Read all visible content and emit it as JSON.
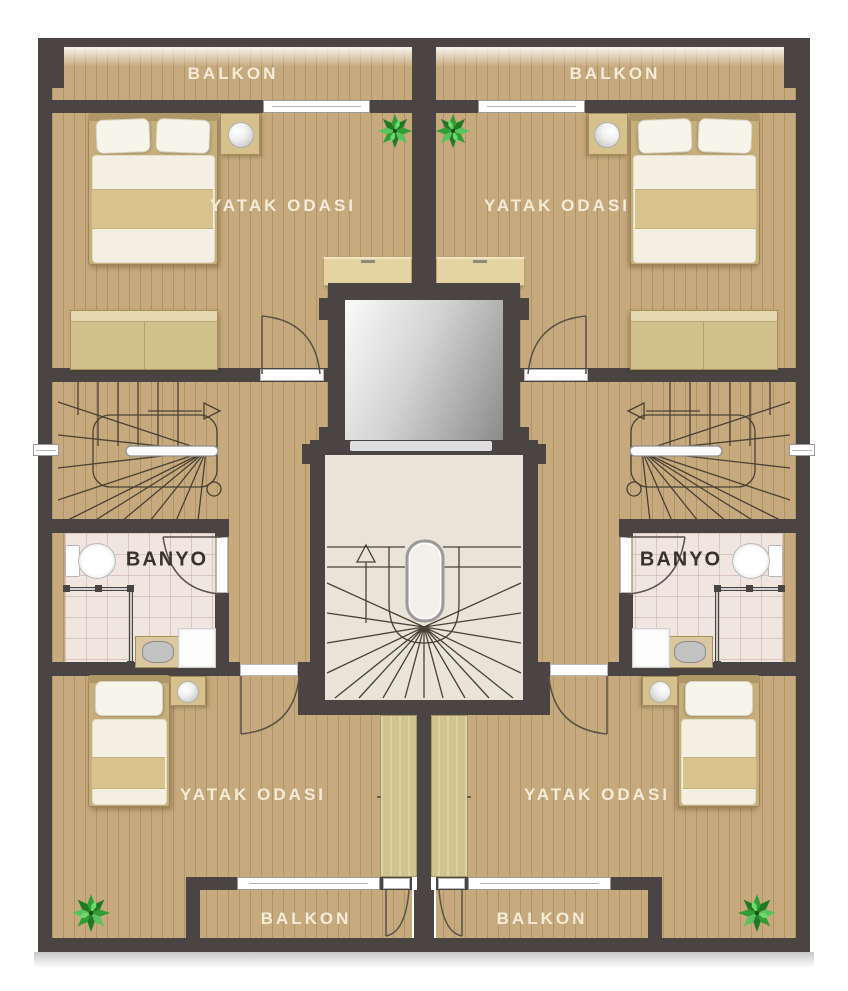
{
  "plan_labels": {
    "balcony": "BALKON",
    "bedroom": "YATAK ODASI",
    "bathroom": "BANYO"
  },
  "rooms": [
    {
      "id": "balcony-top-left",
      "type": "balcony",
      "label": "BALKON"
    },
    {
      "id": "balcony-top-right",
      "type": "balcony",
      "label": "BALKON"
    },
    {
      "id": "bedroom-top-left",
      "type": "bedroom",
      "label": "YATAK ODASI",
      "furniture": [
        "double-bed",
        "nightstand-lamp",
        "wardrobe",
        "cabinet",
        "plant"
      ]
    },
    {
      "id": "bedroom-top-right",
      "type": "bedroom",
      "label": "YATAK ODASI",
      "furniture": [
        "double-bed",
        "nightstand-lamp",
        "wardrobe",
        "cabinet",
        "plant"
      ]
    },
    {
      "id": "bathroom-left",
      "type": "bathroom",
      "label": "BANYO",
      "fixtures": [
        "toilet",
        "corner-shower",
        "sink-vanity",
        "washing-machine"
      ]
    },
    {
      "id": "bathroom-right",
      "type": "bathroom",
      "label": "BANYO",
      "fixtures": [
        "toilet",
        "corner-shower",
        "sink-vanity",
        "washing-machine"
      ]
    },
    {
      "id": "bedroom-bottom-left",
      "type": "bedroom",
      "label": "YATAK ODASI",
      "furniture": [
        "single-bed",
        "nightstand-lamp",
        "plant"
      ]
    },
    {
      "id": "bedroom-bottom-right",
      "type": "bedroom",
      "label": "YATAK ODASI",
      "furniture": [
        "single-bed",
        "nightstand-lamp",
        "plant"
      ]
    },
    {
      "id": "balcony-bottom-left",
      "type": "balcony",
      "label": "BALKON"
    },
    {
      "id": "balcony-bottom-right",
      "type": "balcony",
      "label": "BALKON"
    },
    {
      "id": "apartment-stair-left",
      "type": "winder-stair",
      "symbols": [
        "direction-arrow",
        "circle-marker",
        "handrail"
      ]
    },
    {
      "id": "apartment-stair-right",
      "type": "winder-stair",
      "symbols": [
        "direction-arrow",
        "circle-marker",
        "handrail"
      ]
    },
    {
      "id": "central-stairwell",
      "type": "winder-stair",
      "symbols": [
        "up-arrow",
        "newel",
        "handrail"
      ]
    },
    {
      "id": "elevator-shaft",
      "type": "elevator"
    }
  ],
  "icons": {
    "plant": "plant-icon",
    "lamp": "lamp-icon",
    "toilet": "toilet-icon",
    "shower": "shower-glass-icon",
    "sink": "sink-icon",
    "washer": "washing-machine-icon",
    "stair_arrow": "direction-arrow-icon",
    "window": "window-bar",
    "door": "door-swing-arc"
  },
  "colors": {
    "wall": "#4a4542",
    "floor_wood": "#c6aa7d",
    "floor_plank_line": "#8a6a3e",
    "bath_tile": "#f1e6df",
    "stairwell_floor": "#e9e4d8",
    "cabinet_wood": "#e3d4a2",
    "wardrobe_wood": "#d3c18d",
    "bed_frame": "#c7ae7d",
    "blanket_band": "#d9c48d",
    "label_light": "#f4ecd9",
    "label_dark": "#37322d",
    "elevator_light": "#fbfbfb",
    "elevator_dark": "#8b8b8b",
    "plant_green": "#2f9e33",
    "fixture_white": "#ffffff"
  }
}
